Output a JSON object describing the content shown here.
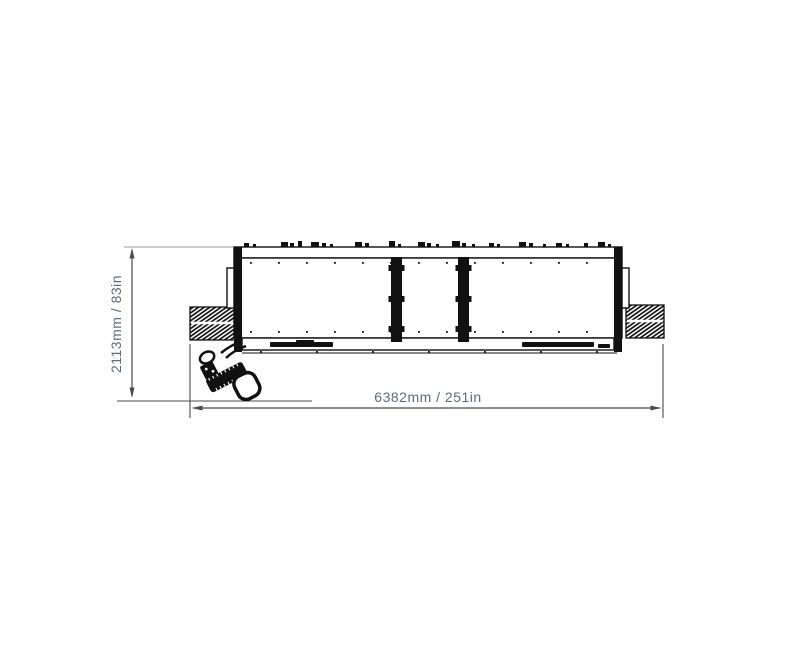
{
  "page": {
    "background": "#ffffff"
  },
  "drawing": {
    "type": "technical-dimension-drawing",
    "subject": "wide-implement-top-view-with-drawbar-hitch",
    "labels": {
      "height": "2113mm / 83in",
      "width": "6382mm / 251in"
    },
    "colors": {
      "outline": "#111111",
      "dim_line": "#4b4b4b",
      "ext_line": "#9b9b9b",
      "label": "#5d6c7c",
      "background": "#ffffff"
    },
    "geometry": {
      "machine": {
        "top_marks": [
          [
            244,
            5,
            4
          ],
          [
            253,
            3,
            3
          ],
          [
            281,
            7,
            5
          ],
          [
            290,
            4,
            4
          ],
          [
            298,
            4,
            6
          ],
          [
            311,
            8,
            5
          ],
          [
            322,
            4,
            4
          ],
          [
            330,
            3,
            3
          ],
          [
            355,
            7,
            5
          ],
          [
            365,
            4,
            4
          ],
          [
            389,
            6,
            6
          ],
          [
            398,
            3,
            3
          ],
          [
            418,
            7,
            5
          ],
          [
            427,
            4,
            4
          ],
          [
            436,
            3,
            3
          ],
          [
            452,
            8,
            6
          ],
          [
            462,
            4,
            4
          ],
          [
            472,
            3,
            3
          ],
          [
            489,
            5,
            4
          ],
          [
            497,
            3,
            3
          ],
          [
            519,
            7,
            5
          ],
          [
            529,
            4,
            4
          ],
          [
            543,
            3,
            3
          ],
          [
            556,
            6,
            4
          ],
          [
            566,
            3,
            3
          ],
          [
            584,
            4,
            4
          ],
          [
            598,
            7,
            5
          ],
          [
            608,
            3,
            3
          ]
        ],
        "dot_rows": [
          {
            "y": 262,
            "x0": 250,
            "x1": 608,
            "step": 28
          },
          {
            "y": 331,
            "x0": 250,
            "x1": 608,
            "step": 28
          },
          {
            "y": 351,
            "x0": 260,
            "x1": 600,
            "step": 56
          }
        ],
        "dividers": [
          {
            "x": 391,
            "y": 257,
            "w": 11,
            "h": 85
          },
          {
            "x": 458,
            "y": 257,
            "w": 11,
            "h": 85
          }
        ],
        "divider_tab_ys": [
          265,
          296,
          326
        ],
        "bottom_bars": [
          {
            "x": 270,
            "y": 342,
            "w": 63,
            "h": 5
          },
          {
            "x": 296,
            "y": 340,
            "w": 18,
            "h": 3
          },
          {
            "x": 522,
            "y": 342,
            "w": 72,
            "h": 5
          },
          {
            "x": 598,
            "y": 344,
            "w": 12,
            "h": 4
          }
        ]
      }
    }
  }
}
